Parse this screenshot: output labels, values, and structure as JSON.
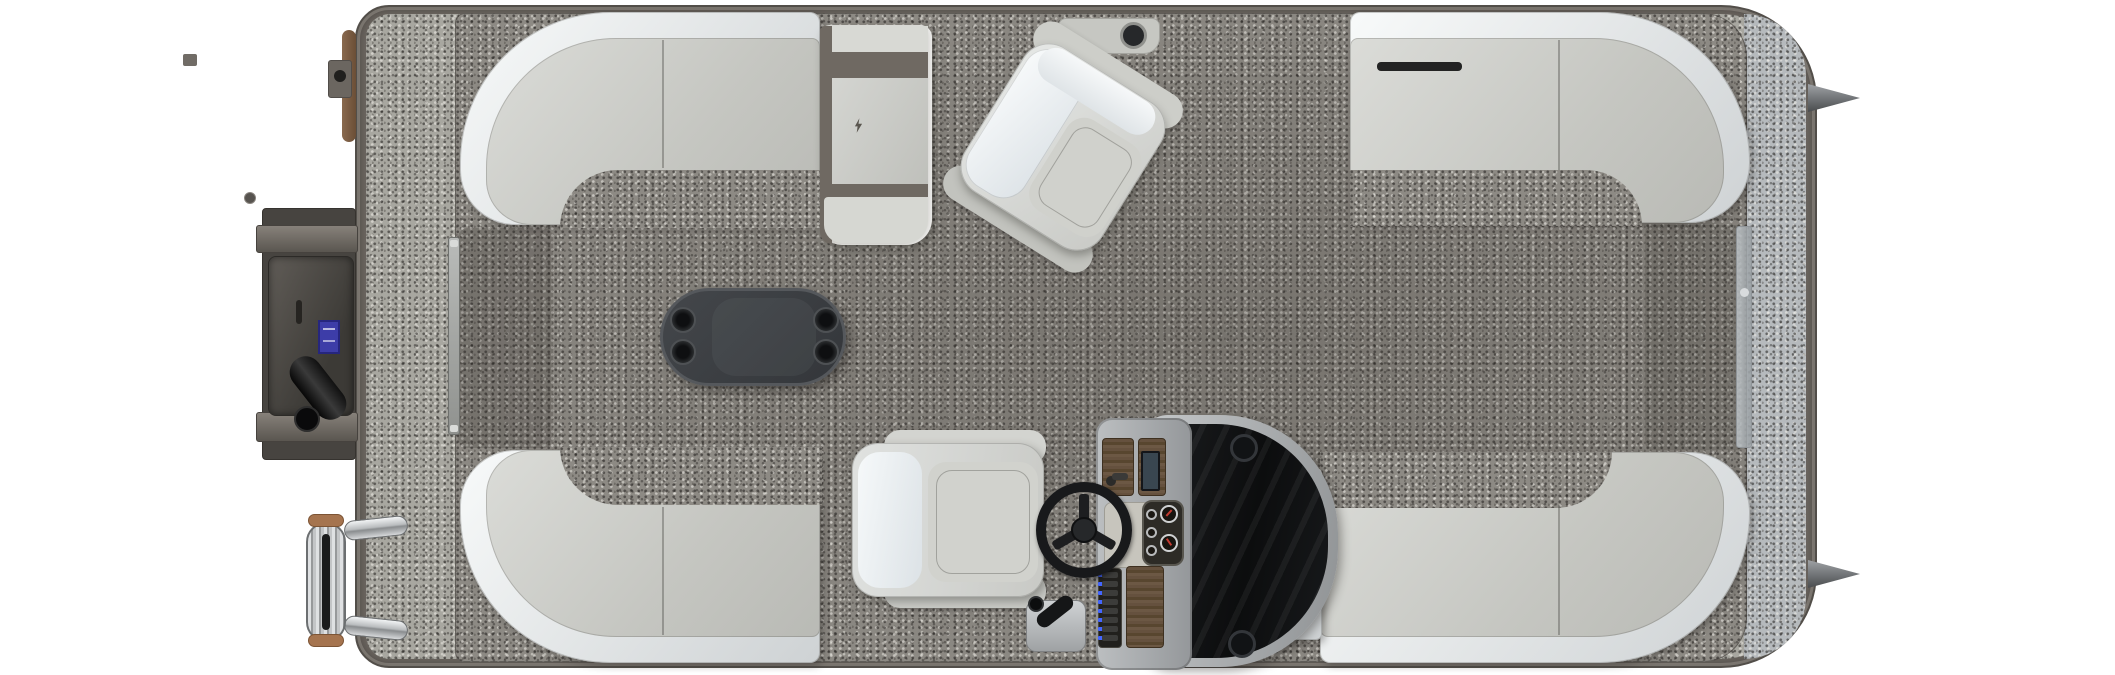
{
  "scene": {
    "title": "Pontoon boat floor plan - overhead view",
    "view": "top-down product render",
    "orientation": {
      "bow": "right",
      "stern": "left"
    },
    "background": "white / transparent"
  },
  "palette": {
    "deck_trim": "#6e6862",
    "deck_trim_dark": "#524e49",
    "carpet_exterior": "#a8a7a0",
    "carpet_bow_platform": "#b6babd",
    "carpet_interior": "#8d8a84",
    "upholstery_back": "#eef0f1",
    "upholstery_seat": "#cdcec9",
    "accent_taupe": "#6f6962",
    "table_charcoal": "#3b3e42",
    "console_silver": "#b4b7b9",
    "windscreen_black": "#121416",
    "dash_wood": "#5d4a39",
    "switch_led_blue": "#4466ff",
    "gauge_needle_red": "#c23a30",
    "motor_gray": "#4a4744",
    "motor_label_blue": "#3d3da8",
    "ladder_chrome": "#d6d8da",
    "grip_tan": "#a5744f"
  },
  "components": {
    "hull": {
      "deck_platform": "rounded rectangle, rounded bow corners",
      "pontoon_nose_cones": 2,
      "bow_gate": "closed, starboard-bow centerline right",
      "stern_gate": "closed, left between stern lounges"
    },
    "power": {
      "outboard_motor": "stern mounted, dark cowling with blue brand label",
      "trim_cylinder": 1,
      "transom_beams": 2
    },
    "seating": {
      "stern_lounges": [
        "port wraparound corner lounge",
        "starboard wraparound corner lounge"
      ],
      "bow_lounges": [
        "port bow wraparound lounge",
        "starboard bow wraparound lounge"
      ],
      "recliner": "port chaise recliner with taupe accent bands",
      "chairs": [
        "companion swivel captain chair (rotated)",
        "helm captain chair"
      ]
    },
    "helm": {
      "steering_wheel": 1,
      "gauges_large": 2,
      "gauges_small": 3,
      "rocker_switches": 8,
      "display_screen": 1,
      "throttle": 1,
      "windscreen": "dark wraparound",
      "corner_speakers": 2,
      "dash": "woodgrain panels"
    },
    "amenities": {
      "table_cup_holders": 4,
      "armrest_cup_holder": 1,
      "boarding_ladder": "folded chrome with tan grips"
    }
  }
}
